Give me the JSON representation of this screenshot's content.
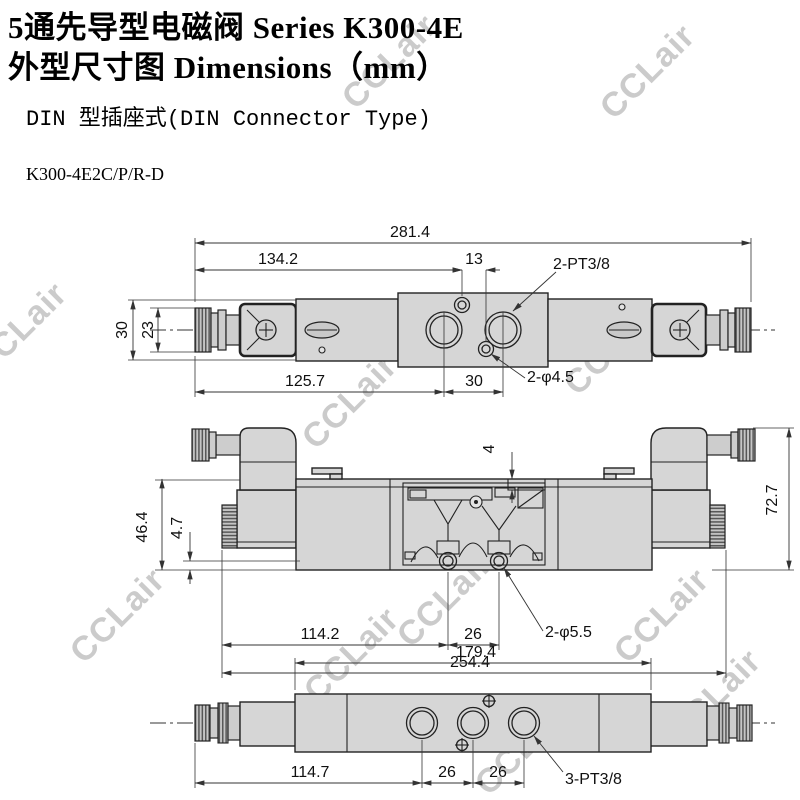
{
  "header": {
    "title_line1": "5通先导型电磁阀  Series K300-4E",
    "title_line2": "外型尺寸图  Dimensions（mm）",
    "subtitle": "DIN 型插座式(DIN Connector Type)",
    "model": "K300-4E2C/P/R-D"
  },
  "watermark": {
    "text": "CCLair"
  },
  "colors": {
    "body_fill": "#d6d6d6",
    "line": "#222222",
    "dim_line": "#333333",
    "watermark": "#cbcbcb",
    "background": "#ffffff"
  },
  "views": {
    "top": {
      "label": "top view",
      "dims": {
        "total_width": "281.4",
        "hole_left_offset": "134.2",
        "hole_spacing": "13",
        "port_thread_label": "2-PT3/8",
        "coil_height": "30",
        "connector_height": "23",
        "port_left_offset": "125.7",
        "port_spacing": "30",
        "mount_hole_label": "2-φ4.5"
      }
    },
    "front": {
      "label": "front view",
      "dims": {
        "pilot_port_depth": "4",
        "body_height": "46.4",
        "hole_bottom_offset": "4.7",
        "total_height": "72.7",
        "hole_left_offset": "114.2",
        "hole_spacing": "26",
        "total_width": "254.4",
        "mount_hole_label": "2-φ5.5"
      }
    },
    "bottom": {
      "label": "bottom view",
      "dims": {
        "body_width": "179.4",
        "port_left_offset": "114.7",
        "port_spacing_1": "26",
        "port_spacing_2": "26",
        "port_thread_label": "3-PT3/8"
      }
    }
  }
}
